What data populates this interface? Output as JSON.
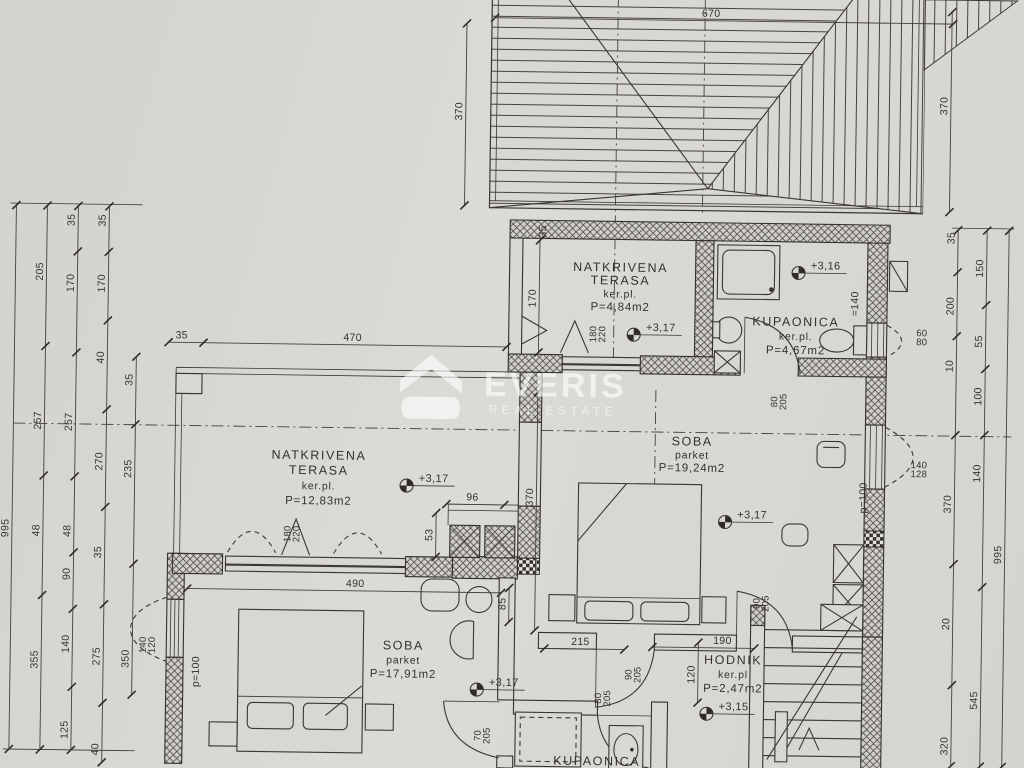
{
  "watermark": {
    "brand": "EVERIS",
    "tagline": "REAL ESTATE"
  },
  "room_labels": [
    {
      "id": "terasa-small",
      "lines": [
        "NATKRIVENA",
        "TERASA",
        "ker.pl.",
        "P=4,84m2"
      ],
      "x": 619,
      "y": 270,
      "lh": 13
    },
    {
      "id": "kupaonica-upper",
      "lines": [
        "KUPAONICA",
        "ker.pl.",
        "P=4,67m2"
      ],
      "x": 795,
      "y": 322,
      "lh": 14
    },
    {
      "id": "soba-large",
      "lines": [
        "SOBA",
        "parket",
        "P=19,24m2"
      ],
      "x": 693,
      "y": 443,
      "lh": 13
    },
    {
      "id": "terasa-large",
      "lines": [
        "NATKRIVENA",
        "TERASA",
        "ker.pl.",
        "P=12,83m2"
      ],
      "x": 320,
      "y": 462,
      "lh": 15
    },
    {
      "id": "soba-small",
      "lines": [
        "SOBA",
        "parket",
        "P=17,91m2"
      ],
      "x": 407,
      "y": 651,
      "lh": 14
    },
    {
      "id": "hodnik",
      "lines": [
        "HODNIK",
        "ker.pl",
        "P=2,47m2"
      ],
      "x": 737,
      "y": 661,
      "lh": 14
    },
    {
      "id": "kupaonica-lower",
      "lines": [
        "KUPAONICA"
      ],
      "x": 602,
      "y": 764,
      "lh": 14
    }
  ],
  "elevation_marks": [
    {
      "t": "+3,17",
      "x": 633,
      "y": 333
    },
    {
      "t": "+3,16",
      "x": 797,
      "y": 269
    },
    {
      "t": "+3,17",
      "x": 408,
      "y": 487
    },
    {
      "t": "+3,17",
      "x": 727,
      "y": 519
    },
    {
      "t": "+3,17",
      "x": 481,
      "y": 690
    },
    {
      "t": "+3,15",
      "x": 711,
      "y": 711
    }
  ],
  "dim_chains_v": [
    {
      "x": 14,
      "y1": 212,
      "y2": 756,
      "labels": [
        {
          "t": "995",
          "y": 535
        }
      ]
    },
    {
      "x": 45,
      "y1": 212,
      "y2": 756,
      "labels": [
        {
          "t": "205",
          "y": 278
        },
        {
          "t": "257",
          "y": 427
        },
        {
          "t": "48",
          "y": 537
        },
        {
          "t": "355",
          "y": 666
        }
      ]
    },
    {
      "x": 76,
      "y1": 212,
      "y2": 756,
      "labels": [
        {
          "t": "35",
          "y": 226
        },
        {
          "t": "170",
          "y": 289
        },
        {
          "t": "257",
          "y": 428
        },
        {
          "t": "48",
          "y": 537
        },
        {
          "t": "90",
          "y": 580
        },
        {
          "t": "140",
          "y": 650
        },
        {
          "t": "125",
          "y": 736
        }
      ]
    },
    {
      "x": 107,
      "y1": 212,
      "y2": 768,
      "labels": [
        {
          "t": "35",
          "y": 226
        },
        {
          "t": "170",
          "y": 289
        },
        {
          "t": "40",
          "y": 363
        },
        {
          "t": "270",
          "y": 467
        },
        {
          "t": "35",
          "y": 558
        },
        {
          "t": "275",
          "y": 662
        },
        {
          "t": "40",
          "y": 755
        }
      ]
    },
    {
      "x": 136,
      "y1": 362,
      "y2": 700,
      "labels": [
        {
          "t": "35",
          "y": 385
        },
        {
          "t": "235",
          "y": 474
        },
        {
          "t": "350",
          "y": 664
        }
      ]
    },
    {
      "x": 462,
      "y1": 24,
      "y2": 206,
      "labels": [
        {
          "t": "370",
          "y": 112
        }
      ]
    },
    {
      "x": 947,
      "y1": 6,
      "y2": 206,
      "labels": [
        {
          "t": "370",
          "y": 100
        }
      ]
    },
    {
      "x": 956,
      "y1": 224,
      "y2": 760,
      "labels": [
        {
          "t": "35",
          "y": 232
        },
        {
          "t": "200",
          "y": 300
        },
        {
          "t": "10",
          "y": 360
        },
        {
          "t": "370",
          "y": 498
        },
        {
          "t": "20",
          "y": 618
        },
        {
          "t": "320",
          "y": 740
        }
      ]
    },
    {
      "x": 985,
      "y1": 224,
      "y2": 760,
      "labels": [
        {
          "t": "150",
          "y": 262
        },
        {
          "t": "55",
          "y": 335
        },
        {
          "t": "100",
          "y": 390
        },
        {
          "t": "140",
          "y": 467
        },
        {
          "t": "545",
          "y": 694
        }
      ]
    },
    {
      "x": 1007,
      "y1": 224,
      "y2": 760,
      "labels": [
        {
          "t": "995",
          "y": 548
        }
      ]
    },
    {
      "x": 538,
      "y1": 240,
      "y2": 352,
      "labels": [
        {
          "t": "170",
          "y": 298
        }
      ]
    },
    {
      "x": 538,
      "y1": 392,
      "y2": 630,
      "labels": [
        {
          "t": "370",
          "y": 497
        }
      ]
    },
    {
      "x": 438,
      "y1": 514,
      "y2": 558,
      "labels": [
        {
          "t": "53",
          "y": 536
        }
      ]
    },
    {
      "x": 512,
      "y1": 588,
      "y2": 622,
      "labels": [
        {
          "t": "85",
          "y": 604
        }
      ]
    },
    {
      "x": 702,
      "y1": 640,
      "y2": 700,
      "labels": [
        {
          "t": "120",
          "y": 672
        }
      ]
    }
  ],
  "dim_chains_h": [
    {
      "y": 18,
      "x1": 490,
      "x2": 948,
      "labels": [
        {
          "t": "670",
          "x": 706
        }
      ]
    },
    {
      "y": 347,
      "x1": 168,
      "x2": 506,
      "ticks": [
        168,
        203,
        506
      ],
      "labels": [
        {
          "t": "35",
          "x": 181
        },
        {
          "t": "470",
          "x": 352
        }
      ]
    },
    {
      "y": 505,
      "x1": 448,
      "x2": 506,
      "labels": [
        {
          "t": "96",
          "x": 474
        }
      ]
    },
    {
      "y": 593,
      "x1": 190,
      "x2": 504,
      "labels": [
        {
          "t": "490",
          "x": 358
        }
      ]
    },
    {
      "y": 648,
      "x1": 548,
      "x2": 628,
      "labels": [
        {
          "t": "215",
          "x": 584
        }
      ]
    },
    {
      "y": 645,
      "x1": 656,
      "x2": 758,
      "labels": [
        {
          "t": "190",
          "x": 726
        }
      ]
    }
  ],
  "opening_labels": [
    {
      "lines": [
        "180",
        "220"
      ],
      "x": 597,
      "y": 333,
      "rot": -90
    },
    {
      "lines": [
        "180",
        "220"
      ],
      "x": 294,
      "y": 537,
      "rot": -90
    },
    {
      "lines": [
        "80",
        "205"
      ],
      "x": 779,
      "y": 398,
      "rot": -90
    },
    {
      "lines": [
        "90",
        "205"
      ],
      "x": 764,
      "y": 600,
      "rot": -90
    },
    {
      "lines": [
        "90",
        "205"
      ],
      "x": 637,
      "y": 673,
      "rot": -90
    },
    {
      "lines": [
        "80",
        "205"
      ],
      "x": 607,
      "y": 697,
      "rot": -90
    },
    {
      "lines": [
        "70",
        "205"
      ],
      "x": 487,
      "y": 736,
      "rot": -90
    },
    {
      "lines": [
        "140",
        "120"
      ],
      "x": 151,
      "y": 650,
      "rot": -90
    },
    {
      "lines": [
        "140",
        "128"
      ],
      "x": 920,
      "y": 464,
      "rot": 0
    },
    {
      "lines": [
        "60",
        "80"
      ],
      "x": 921,
      "y": 332,
      "rot": 0
    }
  ],
  "note_labels": [
    {
      "t": "p=100",
      "x": 203,
      "y": 676,
      "rot": -90
    },
    {
      "t": "p=100",
      "x": 868,
      "y": 493,
      "rot": -90
    },
    {
      "t": "=140",
      "x": 857,
      "y": 299,
      "rot": -90
    },
    {
      "t": "35",
      "x": 544,
      "y": 231,
      "rot": -90
    }
  ]
}
